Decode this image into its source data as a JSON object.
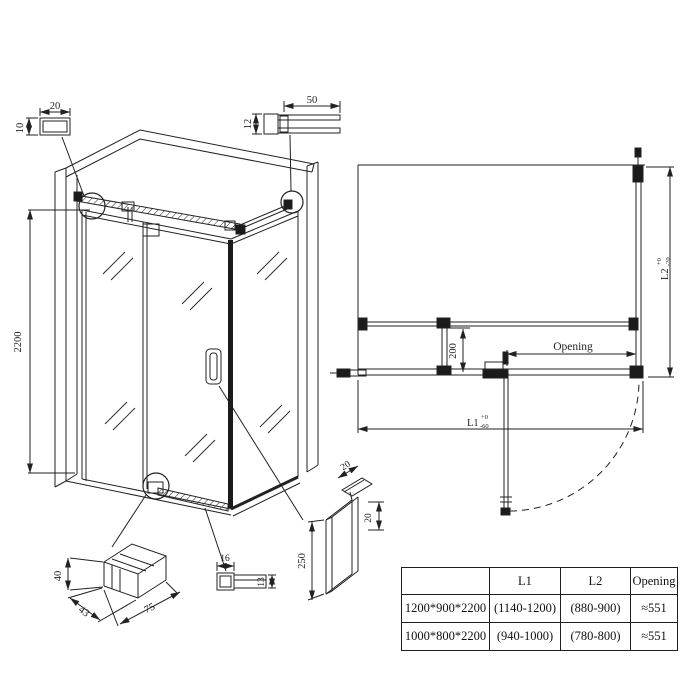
{
  "drawing": {
    "elevation": {
      "height_dim": "2200",
      "top_tube_detail": {
        "width": "20",
        "height": "10"
      },
      "top_profile_detail": {
        "width": "50",
        "height": "12"
      }
    },
    "plan": {
      "l1": {
        "label": "L1",
        "tol_plus": "+0",
        "tol_minus": "-60"
      },
      "l2": {
        "label": "L2",
        "tol_plus": "+0",
        "tol_minus": "-20"
      },
      "opening_label": "Opening",
      "panel_dim": "200"
    },
    "details": {
      "clamp": {
        "height": "40",
        "depth": "43",
        "width": "75"
      },
      "rail": {
        "width": "16",
        "height": "13"
      },
      "handle": {
        "length": "250",
        "thickness": "20",
        "depth": "20"
      }
    }
  },
  "table": {
    "headers": {
      "size": "",
      "l1": "L1",
      "l2": "L2",
      "opening": "Opening"
    },
    "rows": [
      {
        "size": "1200*900*2200",
        "l1": "(1140-1200)",
        "l2": "(880-900)",
        "opening": "≈551"
      },
      {
        "size": "1000*800*2200",
        "l1": "(940-1000)",
        "l2": "(780-800)",
        "opening": "≈551"
      }
    ]
  },
  "colors": {
    "line": "#222222",
    "background": "#ffffff"
  }
}
